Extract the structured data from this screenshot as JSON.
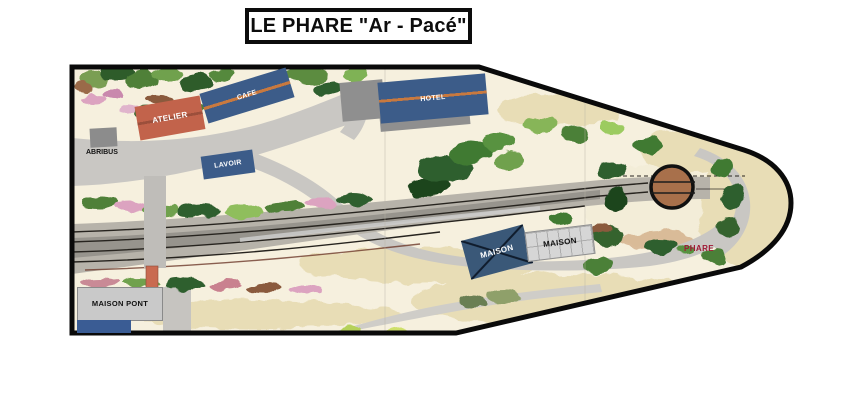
{
  "title": "LE PHARE \"Ar - Pacé\"",
  "map": {
    "buildings": {
      "atelier": {
        "label": "ATELIER",
        "color": "#C2634B"
      },
      "cafe": {
        "label": "CAFE",
        "color": "#3C5C89"
      },
      "hotel": {
        "label": "HOTEL",
        "color": "#3C5C89"
      },
      "lavoir": {
        "label": "LAVOIR",
        "color": "#3C5C89"
      },
      "abribus": {
        "label": "ABRIBUS",
        "color": "#8C8C8C"
      },
      "maison_blue": {
        "label": "MAISON",
        "color": "#3A5878"
      },
      "maison_gray": {
        "label": "MAISON",
        "color": "#D6D6D6"
      },
      "maison_pont": {
        "label": "MAISON PONT",
        "color": "#C9C9C9"
      }
    },
    "labels": {
      "phare": {
        "label": "PHARE",
        "color": "#A01935"
      }
    },
    "features": {
      "turntable": {
        "name": "turntable",
        "color": "#A8704B"
      }
    },
    "colors": {
      "outline": "#0A0A0A",
      "road": "#C9C7C3",
      "sand": "#E8DDB6",
      "terrain": "#F6F0DE",
      "track_rail": "#27241F"
    }
  }
}
